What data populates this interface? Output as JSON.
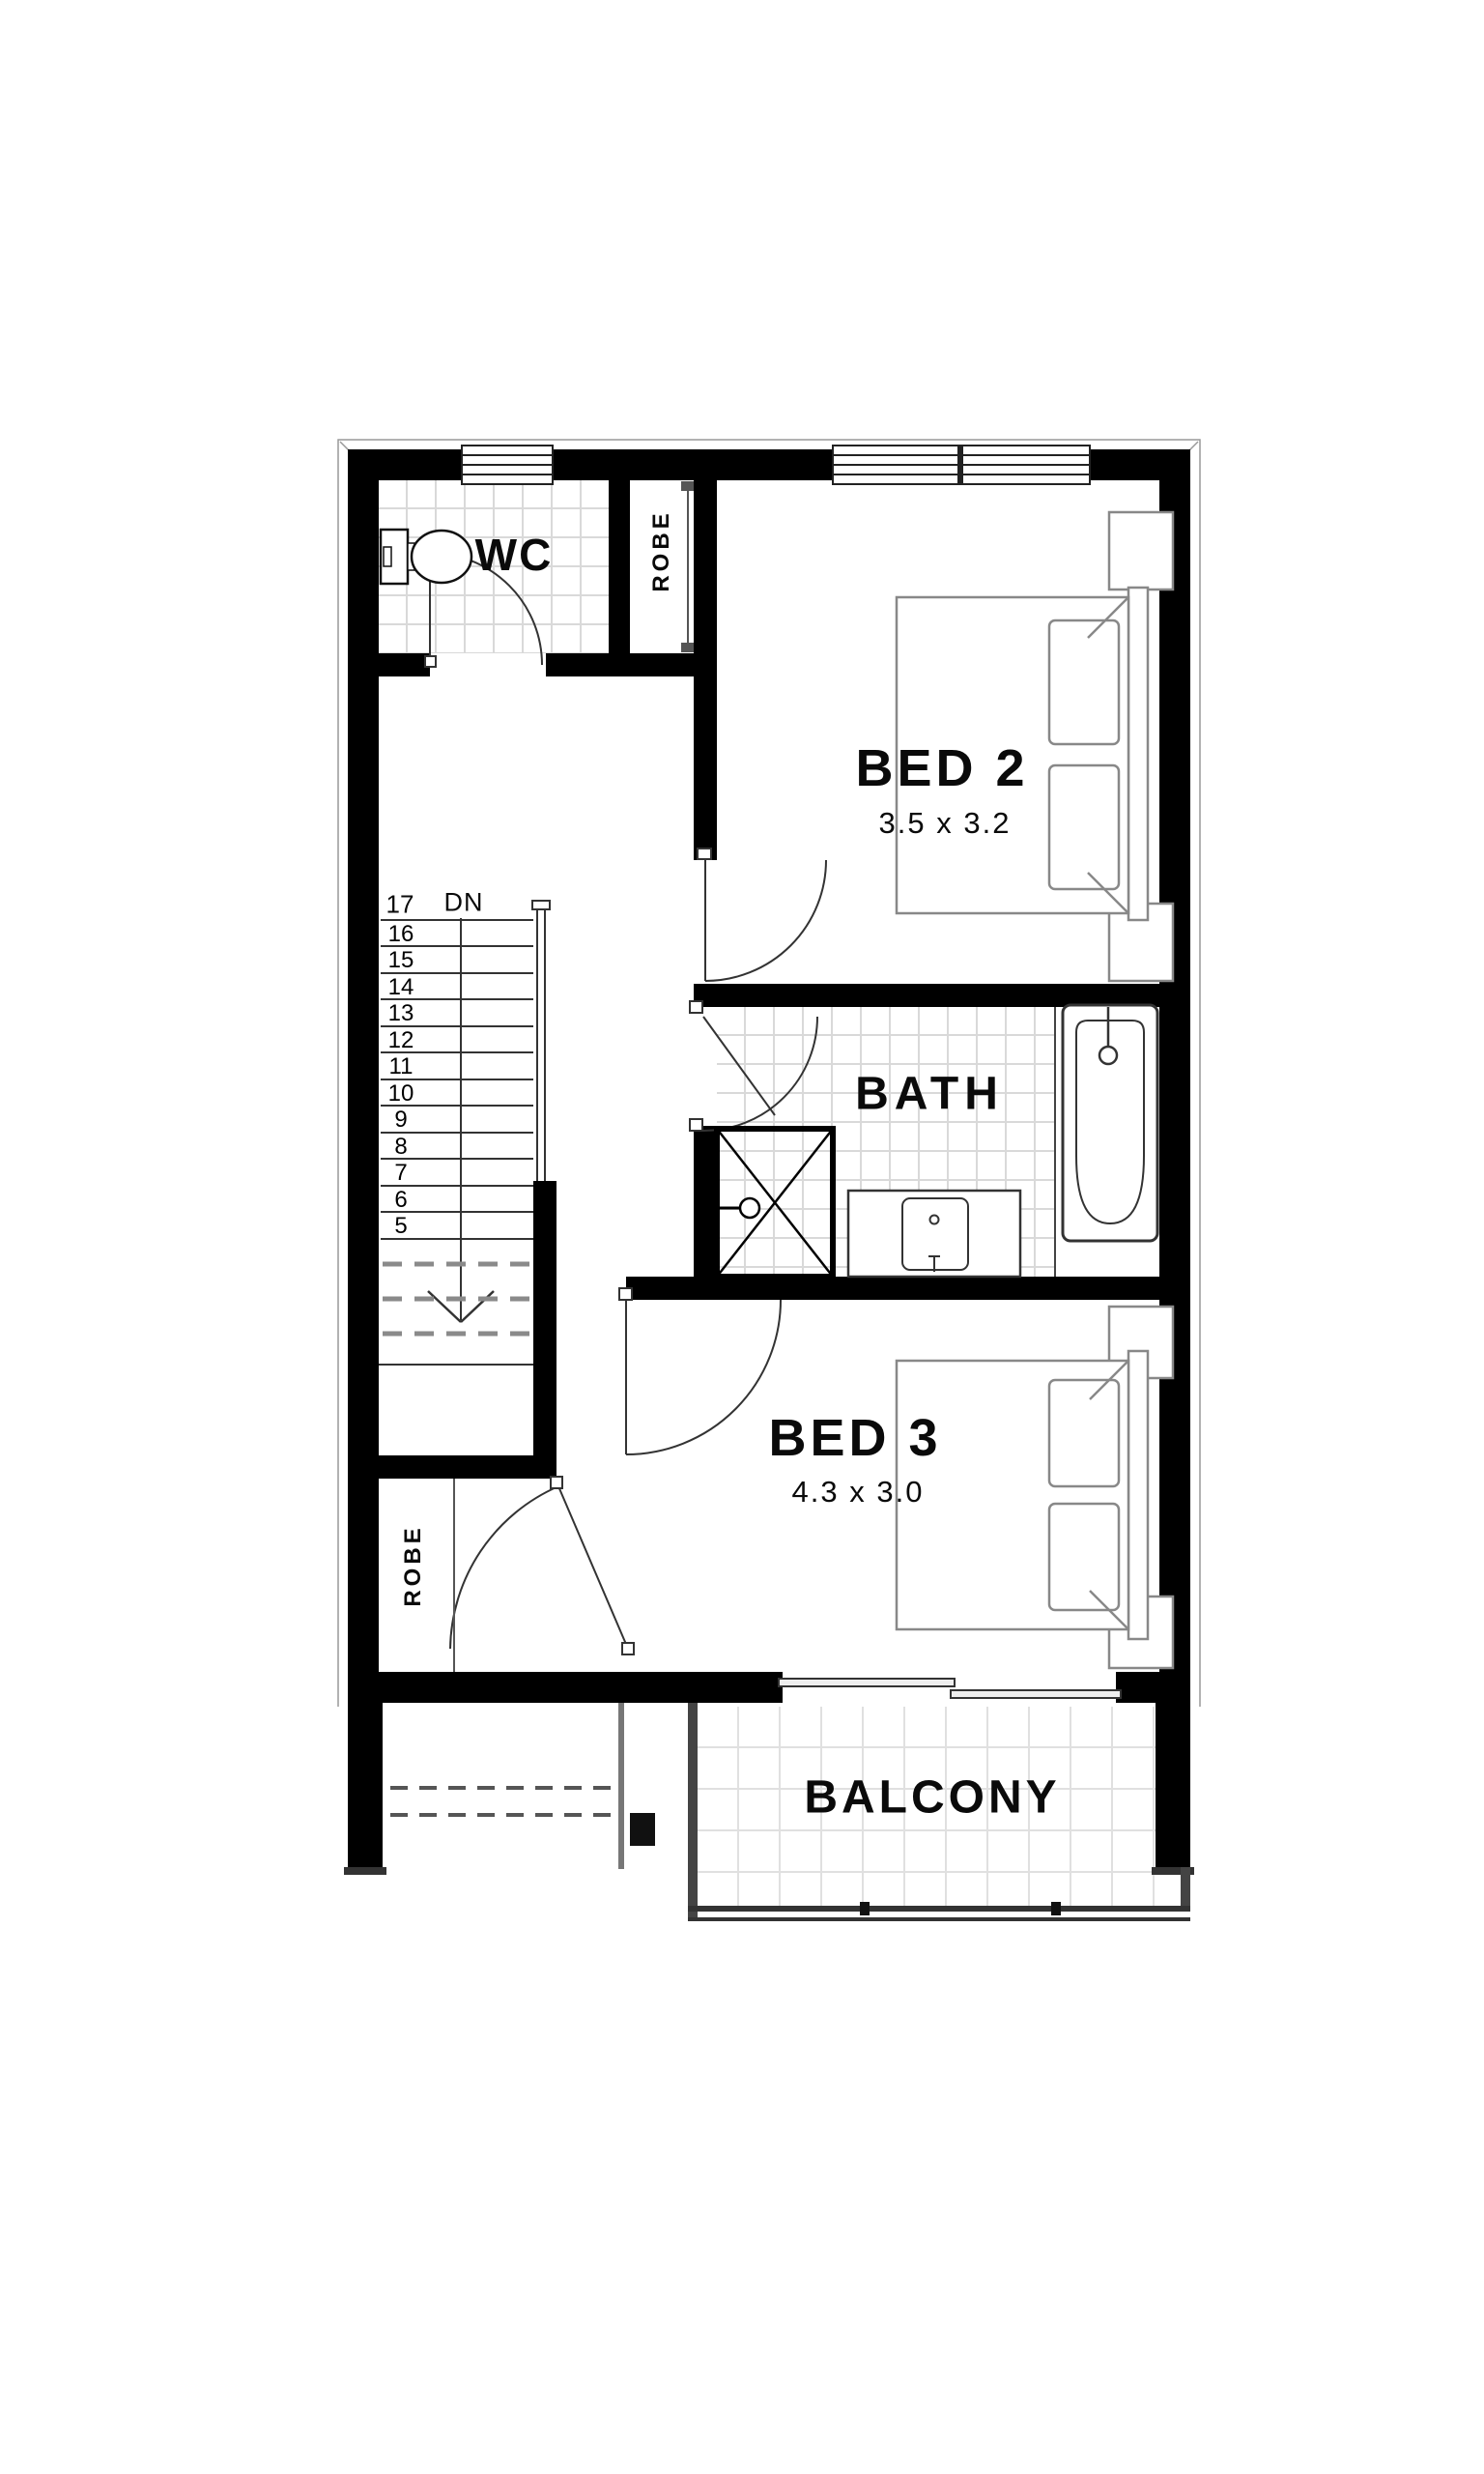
{
  "plan": {
    "type": "floor-plan",
    "colors": {
      "wall": "#000000",
      "line": "#333333",
      "tile_line": "#d9d9d9",
      "dashed": "#8a8a8a",
      "furniture_outline": "#888888"
    }
  },
  "rooms": {
    "wc": {
      "label": "WC"
    },
    "robe_upper": {
      "label": "ROBE"
    },
    "bed2": {
      "label": "BED 2",
      "dims": "3.5 x 3.2"
    },
    "bath": {
      "label": "BATH"
    },
    "bed3": {
      "label": "BED 3",
      "dims": "4.3 x 3.0"
    },
    "robe_lower": {
      "label": "ROBE"
    },
    "balcony": {
      "label": "BALCONY"
    }
  },
  "stairs": {
    "top_step": "17",
    "direction_label": "DN",
    "steps": [
      "16",
      "15",
      "14",
      "13",
      "12",
      "11",
      "10",
      "9",
      "8",
      "7",
      "6",
      "5"
    ]
  },
  "fixtures": [
    "toilet-icon",
    "shower-icon",
    "vanity-basin-icon",
    "bathtub-icon",
    "double-bed-icon",
    "bedside-table-icon",
    "stair-handrail",
    "hinged-door",
    "sliding-door",
    "window",
    "down-arrow-icon"
  ]
}
